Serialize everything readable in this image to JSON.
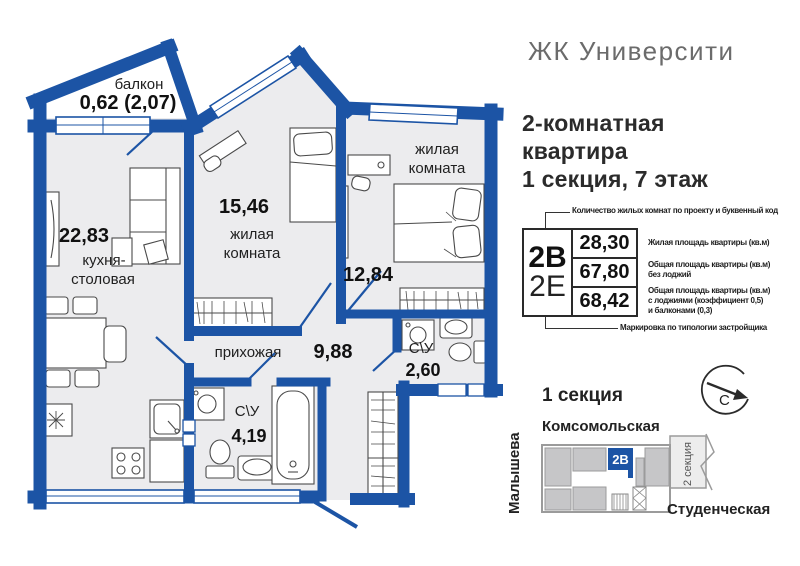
{
  "header": {
    "title": "ЖК Университи"
  },
  "subtitle": {
    "lines": [
      "2-комнатная",
      "квартира",
      "1 секция, 7 этаж"
    ]
  },
  "plan": {
    "balcony": {
      "name": "балкон",
      "area": "0,62 (2,07)"
    },
    "kitchen": {
      "area": "22,83",
      "name1": "кухня-",
      "name2": "столовая"
    },
    "bedroom1": {
      "area": "15,46",
      "name1": "жилая",
      "name2": "комната"
    },
    "bedroom2": {
      "area": "12,84",
      "name1": "жилая",
      "name2": "комната"
    },
    "hall": {
      "name": "прихожая",
      "area": "9,88"
    },
    "bath1": {
      "name": "С\\У",
      "area": "4,19"
    },
    "bath2": {
      "name": "С\\У",
      "area": "2,60"
    }
  },
  "legend": {
    "top_note": "Количество жилых комнат по проекту и буквенный код",
    "code_main": "2В",
    "code_alt": "2Е",
    "rows": [
      {
        "value": "28,30",
        "label_lines": [
          "Жилая площадь квартиры (кв.м)"
        ]
      },
      {
        "value": "67,80",
        "label_lines": [
          "Общая площадь квартиры (кв.м)",
          "без лоджий"
        ]
      },
      {
        "value": "68,42",
        "label_lines": [
          "Общая площадь квартиры (кв.м)",
          "с лоджиями (коэффициент 0,5)",
          "и балконами (0,3)"
        ]
      }
    ],
    "bottom_note": "Маркировка по типологии застройщика"
  },
  "minimap": {
    "section_title": "1 секция",
    "streets": {
      "top": "Комсомольская",
      "left": "Малышева",
      "bottom": "Студенческая"
    },
    "unit_label": "2В",
    "section2_label": "2 секция",
    "compass_letter": "С"
  },
  "colors": {
    "wall_blue": "#1c54a5",
    "room_fill": "#ececee",
    "map_gray": "#c6c6c8"
  }
}
